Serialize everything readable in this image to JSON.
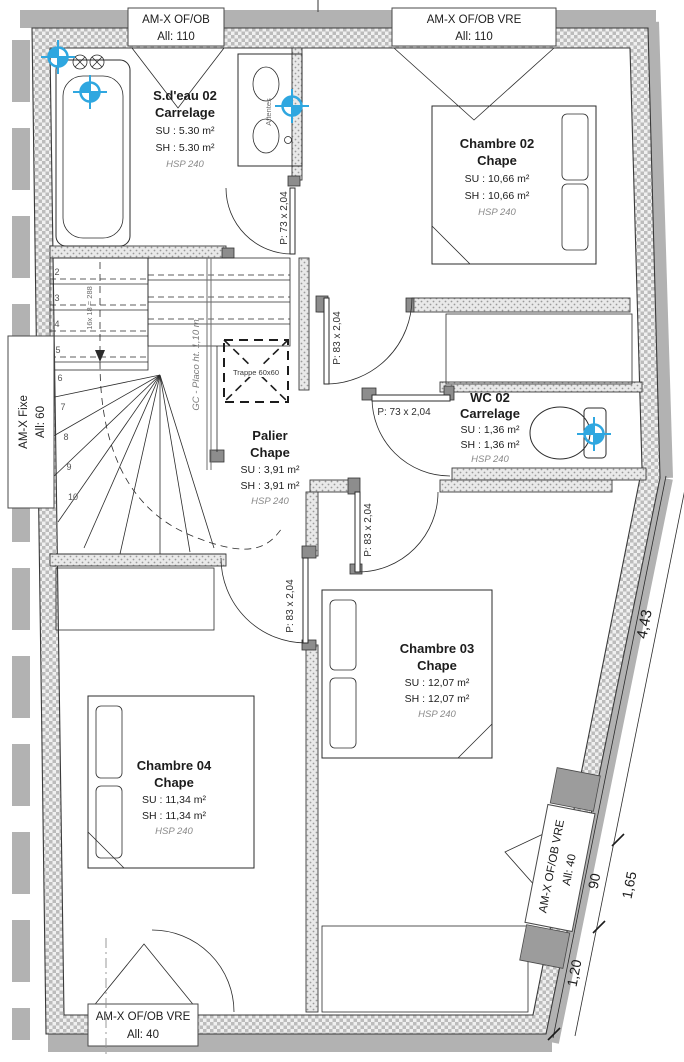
{
  "plan": {
    "type": "floor-plan",
    "floor": "étage"
  },
  "rooms": [
    {
      "name": "S.d'eau 02",
      "finish": "Carrelage",
      "su": "SU : 5.30 m²",
      "sh": "SH : 5.30 m²",
      "hsp": "HSP 240"
    },
    {
      "name": "Chambre 02",
      "finish": "Chape",
      "su": "SU : 10,66 m²",
      "sh": "SH : 10,66 m²",
      "hsp": "HSP 240"
    },
    {
      "name": "WC 02",
      "finish": "Carrelage",
      "su": "SU : 1,36 m²",
      "sh": "SH : 1,36 m²",
      "hsp": "HSP 240"
    },
    {
      "name": "Palier",
      "finish": "Chape",
      "su": "SU : 3,91 m²",
      "sh": "SH : 3,91 m²",
      "hsp": "HSP 240"
    },
    {
      "name": "Chambre 03",
      "finish": "Chape",
      "su": "SU : 12,07 m²",
      "sh": "SH : 12,07 m²",
      "hsp": "HSP 240"
    },
    {
      "name": "Chambre 04",
      "finish": "Chape",
      "su": "SU : 11,34 m²",
      "sh": "SH : 11,34 m²",
      "hsp": "HSP 240"
    }
  ],
  "windows": [
    {
      "position": "top-left",
      "label1": "AM-X OF/OB",
      "label2": "All: 110"
    },
    {
      "position": "top-right",
      "label1": "AM-X OF/OB VRE",
      "label2": "All: 110"
    },
    {
      "position": "left",
      "label1": "AM-X Fixe",
      "label2": "All: 60"
    },
    {
      "position": "bottom",
      "label1": "AM-X OF/OB VRE",
      "label2": "All: 40"
    },
    {
      "position": "right-diagonal",
      "label1": "AM-X OF/OB VRE",
      "label2": "All: 40"
    }
  ],
  "doors": [
    {
      "room": "S.d'eau 02",
      "label": "P: 73 x 2,04"
    },
    {
      "room": "Chambre 02",
      "label": "P: 83 x 2,04"
    },
    {
      "room": "WC 02",
      "label": "P: 73 x 2,04"
    },
    {
      "room": "Chambre 03",
      "label": "P: 83 x 2,04"
    },
    {
      "room": "Chambre 04",
      "label": "P: 83 x 2,04"
    }
  ],
  "stairs": {
    "numbers": [
      "2",
      "3",
      "4",
      "5",
      "6",
      "7",
      "8",
      "9",
      "10"
    ],
    "rise_note": "16x 18 = 288",
    "guard_note": "GC - Placo ht. 1,10 m"
  },
  "annotations": {
    "trappe": "Trappe 60x60",
    "attentes": "Attentes"
  },
  "dimensions": {
    "overall": "4,43",
    "seg_90": "90",
    "seg_165": "1,65",
    "seg_120": "1,20"
  },
  "colors": {
    "target_blue": "#2fa7e0",
    "wall_gray": "#bcbcbc",
    "roof_band_gray": "#b2b2b2",
    "line_dark": "#2b2b2b",
    "muted_gray": "#8a8a8a"
  }
}
